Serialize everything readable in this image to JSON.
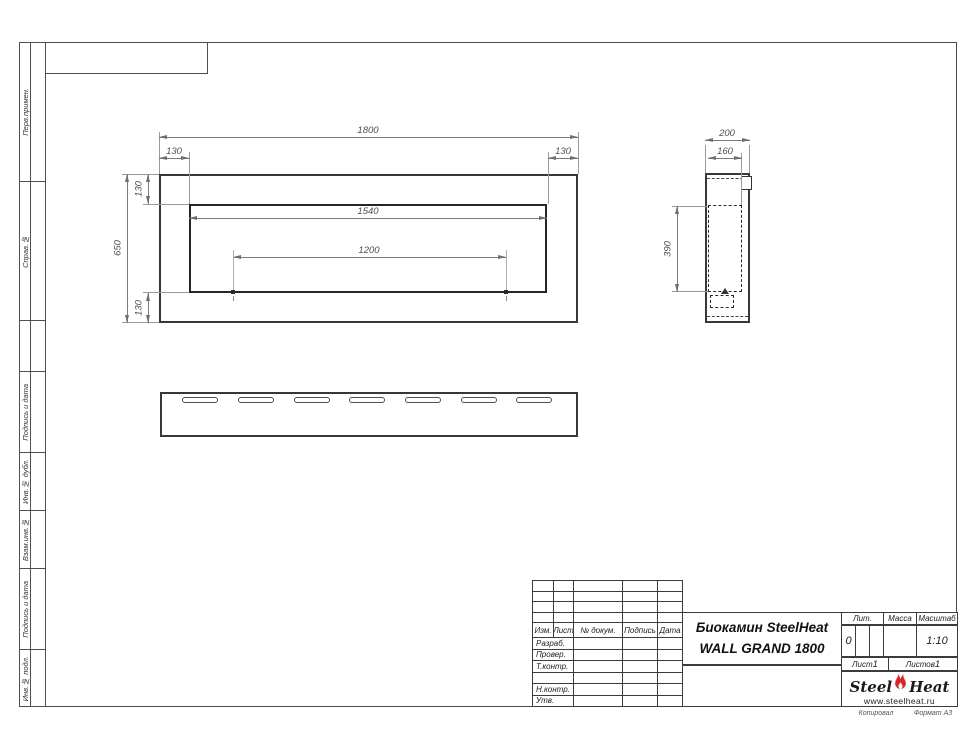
{
  "margin_strip": {
    "sections": [
      {
        "label": "Перв.примен."
      },
      {
        "label": "Справ.№"
      },
      {
        "label": ""
      },
      {
        "label": "Подпись и дата"
      },
      {
        "label": "Инв.№ дубл."
      },
      {
        "label": "Взам.инв.№"
      },
      {
        "label": "Подпись и дата"
      },
      {
        "label": "Инв.№ подл."
      }
    ]
  },
  "views": {
    "front": {
      "dim_total_w": "1800",
      "dim_inset_l": "130",
      "dim_inset_r": "130",
      "dim_border_t": "130",
      "dim_total_h": "650",
      "dim_border_b": "130",
      "dim_opening_w": "1540",
      "dim_burner_w": "1200"
    },
    "side": {
      "dim_depth": "200",
      "dim_depth_inner": "160",
      "dim_opening_h": "390"
    },
    "bottom": {
      "vent_slots": 7
    }
  },
  "stamp": {
    "change_header": [
      "Изм.",
      "Лист",
      "№ докум.",
      "Подпись",
      "Дата"
    ],
    "sig_rows": [
      "Разраб.",
      "Провер.",
      "Т.контр.",
      "",
      "Н.контр.",
      "Утв."
    ],
    "title_line1": "Биокамин SteelHeat",
    "title_line2": "WALL GRAND 1800",
    "lit_label": "Лит.",
    "lit_value": "0",
    "mass_label": "Масса",
    "scale_label": "Масштаб",
    "scale_value": "1:10",
    "sheet_label": "Лист",
    "sheet_value": "1",
    "sheets_label": "Листов",
    "sheets_value": "1",
    "brand": {
      "word1": "Steel",
      "word2": "Heat",
      "site": "www.steelheat.ru",
      "flame_color": "#e31e24"
    }
  },
  "footer": {
    "copied": "Копировал",
    "format": "Формат А3"
  }
}
